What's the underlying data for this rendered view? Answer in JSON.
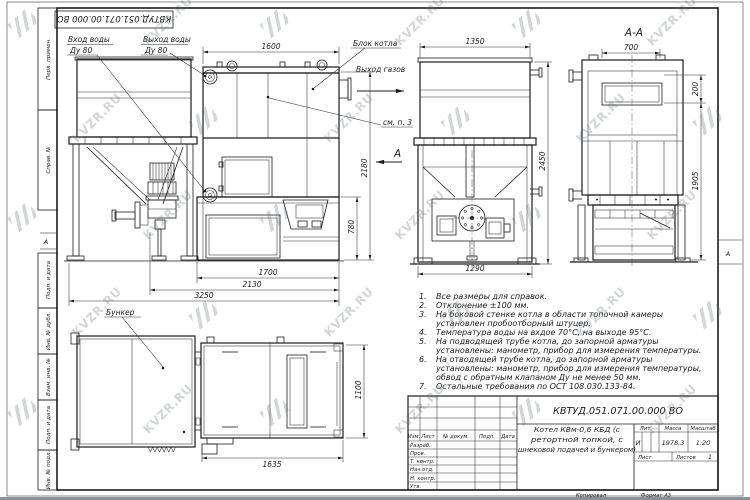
{
  "watermark": {
    "text": "KVZR.RU"
  },
  "stamp": {
    "code": "КВТУД.051.071.00.000 ВО"
  },
  "margin": {
    "perv": "Перв. примен.",
    "sprav": "Справ. №",
    "podp1": "Подп. и дата",
    "inv_dubl": "Инв. № дубл.",
    "vzam": "Взам. инв. №",
    "podp2": "Подп. и дата",
    "inv_podl": "Инв. № подл.",
    "zone_left": "А",
    "zone_right": "А"
  },
  "labels": {
    "inlet_l1": "Вход воды",
    "inlet_l2": "Ду 80",
    "outlet_l1": "Выход воды",
    "outlet_l2": "Ду 80",
    "block": "Блок котла",
    "gas": "Выход газов",
    "see_note": "см. п. 3",
    "section_mark": "А",
    "section_title": "А-А",
    "bunker": "Бункер"
  },
  "dims": {
    "d1600": "1600",
    "d2180": "2180",
    "d780": "780",
    "d1700": "1700",
    "d2130": "2130",
    "d3250": "3250",
    "d1350": "1350",
    "d2450": "2450",
    "d1290": "1290",
    "d700": "700",
    "d200": "200",
    "d1905": "1905",
    "d1100": "1100",
    "d1635": "1635"
  },
  "notes": [
    {
      "num": "1.",
      "text": "Все размеры для справок."
    },
    {
      "num": "2.",
      "text": "Отклонение ±100 мм."
    },
    {
      "num": "3.",
      "text": "На боковой стенке котла в области топочной камеры установлен пробоотборный штуцер."
    },
    {
      "num": "4.",
      "text": "Температура воды на вхдое 70°С, на выходе 95°С."
    },
    {
      "num": "5.",
      "text": "На подводящей трубе котла, до запорной арматуры установлены: манометр, прибор для измерения температуры."
    },
    {
      "num": "6.",
      "text": "На отводящей трубе котла, до запорной арматуры установлены: манометр, прибор для измерения температуры, обвод с обратным клапаном Ду не менее 50 мм."
    },
    {
      "num": "7.",
      "text": "Остальные требования по ОСТ 108.030.133-84."
    }
  ],
  "titleblock": {
    "designation": "КВТУД.051.071.00.000 ВО",
    "name_lines": [
      "Котел КВм-0,6 КБД (с",
      "ретортной топкой, с",
      "шнековой подачей и бункером)"
    ],
    "cols": {
      "izm": "Изм.",
      "list": "Лист",
      "doc": "№ докум.",
      "podp": "Подп.",
      "data": "Дата"
    },
    "rows": {
      "razrab": "Разраб.",
      "prov": "Пров.",
      "tkontr": "Т. контр.",
      "nachotd": "Нач.отд.",
      "nkontr": "Н. контр.",
      "utv": "Утв."
    },
    "lit_label": "Лит.",
    "lit": "И",
    "mass_label": "Масса",
    "mass": "1978,3",
    "scale_label": "Масштаб",
    "scale": "1:20",
    "sheet_label": "Лист",
    "sheets_label": "Листов",
    "sheets": "1"
  },
  "footer": {
    "copied": "Копировал",
    "format": "Формат А3"
  }
}
